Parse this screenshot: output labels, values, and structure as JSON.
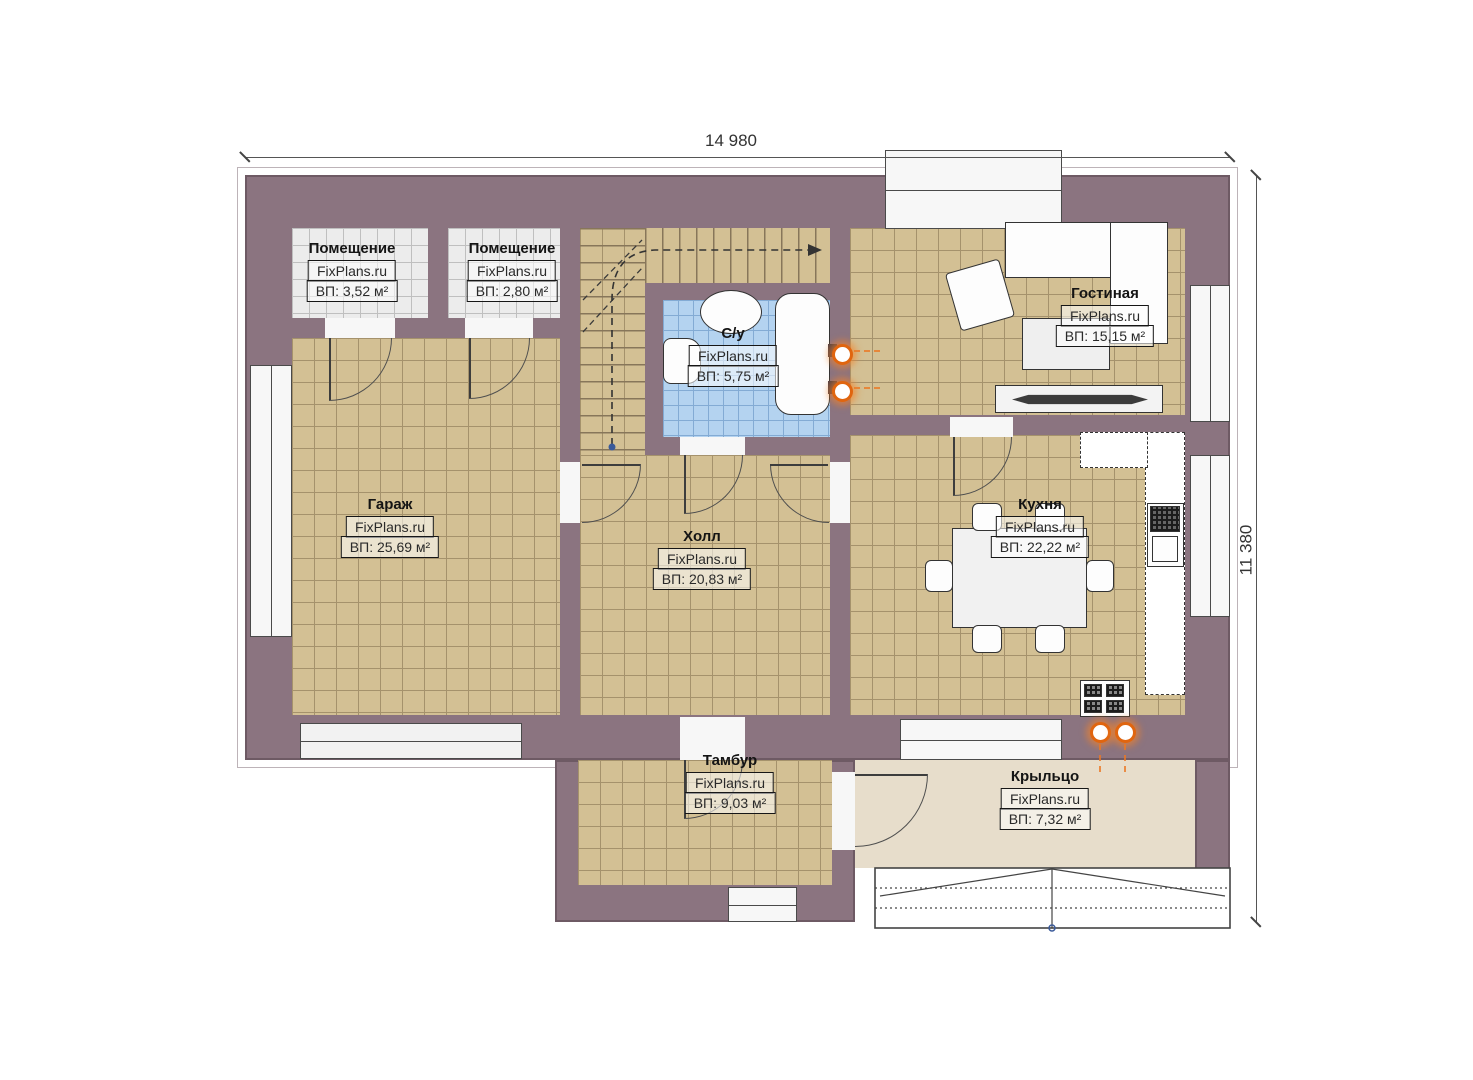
{
  "watermark": "FixPlans.ru",
  "dimensions": {
    "width_label": "14 980",
    "height_label": "11 380"
  },
  "rooms": [
    {
      "id": "storage-1",
      "name": "Помещение",
      "area": "ВП: 3,52 м²"
    },
    {
      "id": "storage-2",
      "name": "Помещение",
      "area": "ВП: 2,80 м²"
    },
    {
      "id": "bathroom",
      "name": "С/у",
      "area": "ВП: 5,75 м²"
    },
    {
      "id": "living-room",
      "name": "Гостиная",
      "area": "ВП: 15,15 м²"
    },
    {
      "id": "garage",
      "name": "Гараж",
      "area": "ВП: 25,69 м²"
    },
    {
      "id": "hall",
      "name": "Холл",
      "area": "ВП: 20,83 м²"
    },
    {
      "id": "kitchen",
      "name": "Кухня",
      "area": "ВП: 22,22 м²"
    },
    {
      "id": "vestibule",
      "name": "Тамбур",
      "area": "ВП: 9,03 м²"
    },
    {
      "id": "porch",
      "name": "Крыльцо",
      "area": "ВП: 7,32 м²"
    }
  ],
  "colors": {
    "wall": "#8b7480",
    "floor_main": "#d3c094",
    "floor_storage": "#ececec",
    "floor_bath": "#b4d3f0",
    "floor_porch": "#e7ddcb",
    "heating_accent": "#e0650f"
  }
}
